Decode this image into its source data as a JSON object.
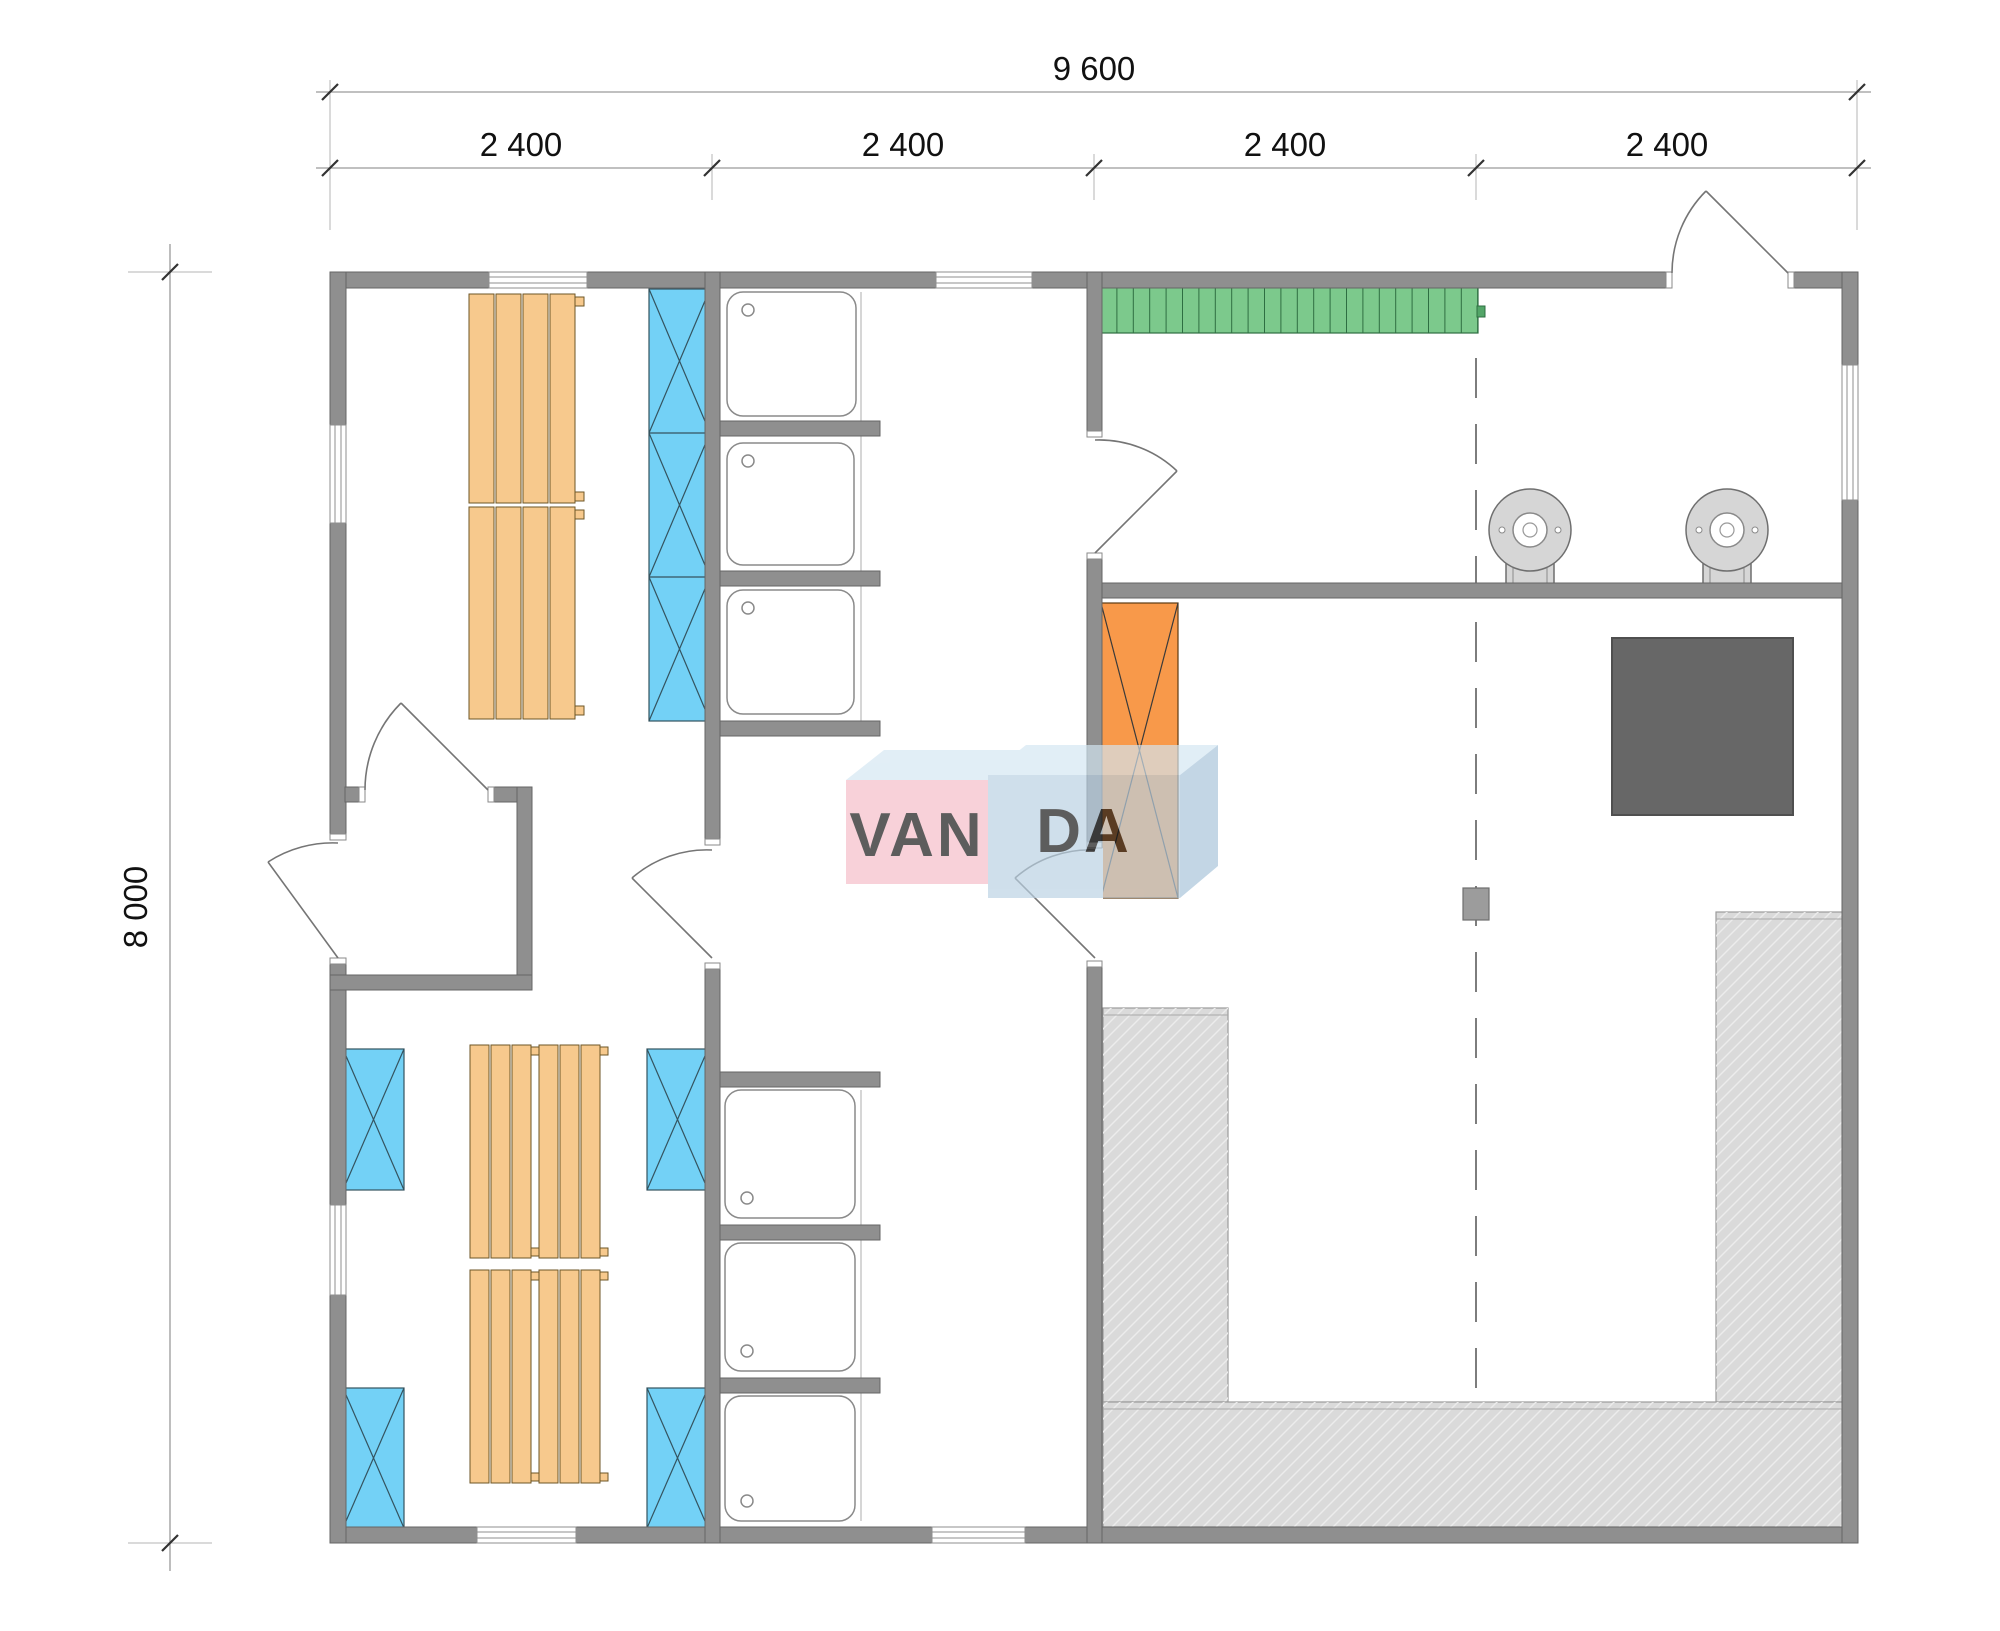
{
  "meta": {
    "drawing_type": "modular building floor plan",
    "units": "mm"
  },
  "dimensions": {
    "total_width_label": "9 600",
    "total_height_label": "8 000",
    "module_labels": [
      "2 400",
      "2 400",
      "2 400",
      "2 400"
    ]
  },
  "watermark": {
    "brand": "VANDA",
    "text_left": "VAN",
    "text_right": "DA"
  },
  "fixtures": {
    "shower_stalls": 6,
    "round_wall_heaters": 2,
    "wood_bench_columns_room1": 4,
    "wood_bench_clusters_room2": 4,
    "blue_cabinet_cells_room1": 3,
    "blue_cabinet_boxes_room2": 4,
    "green_slatted_bench": 1,
    "orange_heater_unit": 1,
    "dark_stove_square": 1,
    "hatched_platforms": 3,
    "support_column": 1
  },
  "colors": {
    "wall": "#8f8f8f",
    "bench_wood": "#f7c98d",
    "cabinet_blue": "#73d1f6",
    "bench_green": "#7cc98c",
    "heater_orange": "#f8994a",
    "stove_dark": "#676767",
    "platform_gray": "#dadada",
    "watermark_pink": "#f6bcc8",
    "watermark_blue": "#b9d1e3",
    "watermark_top": "#d4e6f2"
  }
}
